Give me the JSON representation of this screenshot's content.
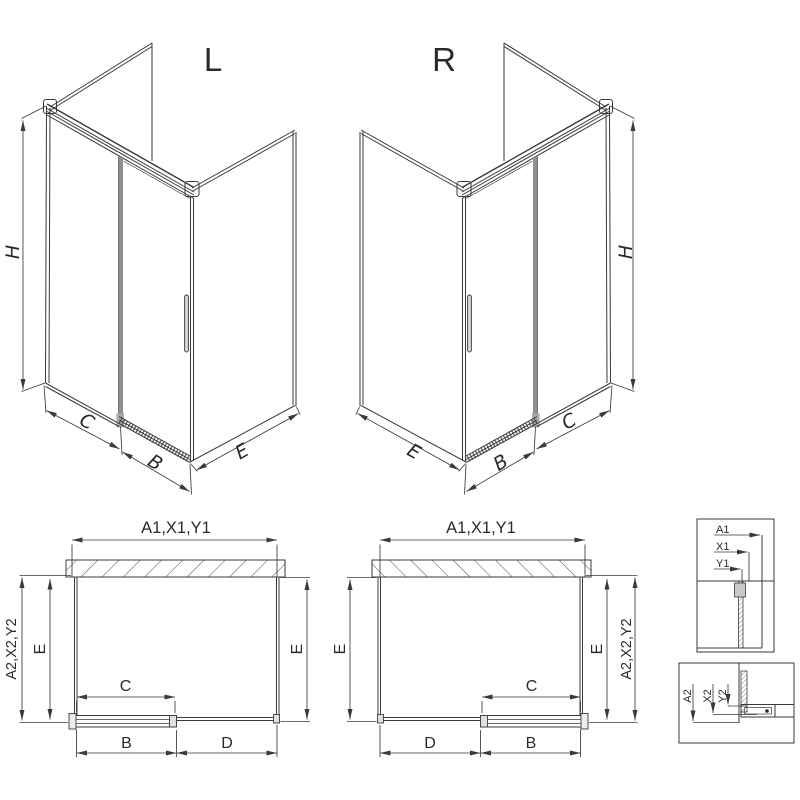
{
  "drawing": {
    "iso_left": {
      "label": "L",
      "dim_height": "H",
      "dim_panel": "C",
      "dim_door": "B",
      "dim_side": "E"
    },
    "iso_right": {
      "label": "R",
      "dim_height": "H",
      "dim_panel": "C",
      "dim_door": "B",
      "dim_side": "E"
    },
    "plan_left": {
      "dim_width": "A1,X1,Y1",
      "dim_depth": "A2,X2,Y2",
      "dim_side_left": "E",
      "dim_side_right": "E",
      "dim_door_glass": "C",
      "dim_bottom_left": "B",
      "dim_bottom_right": "D"
    },
    "plan_right": {
      "dim_width": "A1,X1,Y1",
      "dim_depth": "A2,X2,Y2",
      "dim_side_left": "E",
      "dim_side_right": "E",
      "dim_door_glass": "C",
      "dim_bottom_left": "D",
      "dim_bottom_right": "B"
    },
    "detail_width": {
      "labels": [
        "A1",
        "X1",
        "Y1"
      ]
    },
    "detail_depth": {
      "labels": [
        "A2",
        "X2",
        "Y2"
      ]
    }
  },
  "colors": {
    "line": "#3a3a3a",
    "glass_edge": "#909090",
    "background": "#ffffff"
  }
}
